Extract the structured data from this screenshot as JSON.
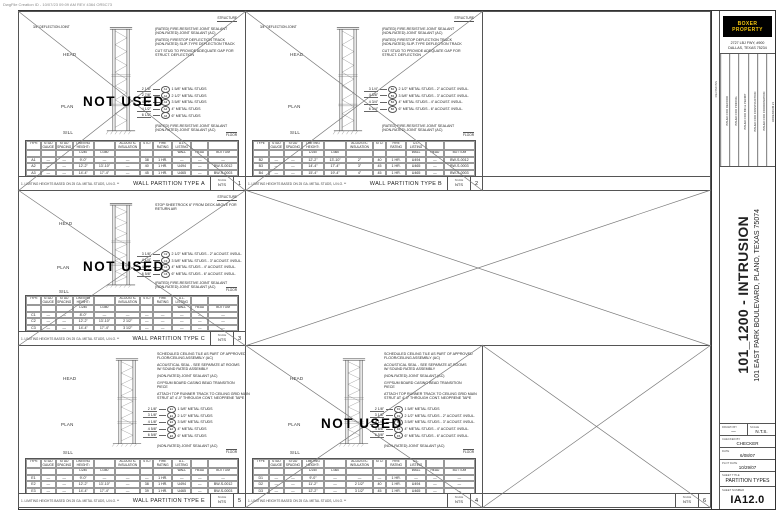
{
  "plot_stamp": "DwgFile Creation ID - 10/07/23 09:09 AM REV 4364 OR5C73",
  "table_note": "1. LIMITING HEIGHTS BASED ON 25 GA. METAL STUDS, U.N.O. **",
  "panels": {
    "a": {
      "title": "WALL PARTITION TYPE A",
      "number": "1",
      "scale_label": "SCALE",
      "scale": "NTS",
      "footnote": "1. LIMITING HEIGHTS BASED ON 25 GA. METAL STUDS, U.N.O. **",
      "not_used": "NOT USED",
      "structure_label": "STRUCTURE",
      "floor_label": "FLOOR",
      "deflection_label": "3/4\" DEFLECTION JOINT",
      "head_label": "HEAD",
      "plan_label": "PLAN",
      "sill_label": "SILL",
      "notes_top": [
        "(RATED) FIRE-RESISTIVE JOINT SEALANT\n(NON-RATED) JOINT SEALANT (AC)",
        "(RATED) FIRESTOP DEFLECTION TRACK\n(NON-RATED) SLIP-TYPE DEFLECTION TRACK",
        "CUT STUD TO PROVIDE ADEQUATE GAP FOR\nSTRUCT. DEFLECTION"
      ],
      "studs": [
        {
          "dim": "2 1/8\"",
          "tag": "A1",
          "text": "1 5/8\" METAL STUDS"
        },
        {
          "dim": "2 7/8\"",
          "tag": "A2",
          "text": "2 1/2\" METAL STUDS"
        },
        {
          "dim": "4 1/8\"",
          "tag": "A3",
          "text": "3 5/8\" METAL STUDS"
        },
        {
          "dim": "4 1/2\"",
          "tag": "A4",
          "text": "4\" METAL STUDS"
        },
        {
          "dim": "6 1/2\"",
          "tag": "A6",
          "text": "6\" METAL STUDS"
        }
      ],
      "note_bottom": "(RATED) FIRE-RESISTIVE JOINT SEALANT\n(NON-RATED) JOINT SEALANT (AC)",
      "table": {
        "rows": [
          [
            "TYPE",
            "STUD GAUGE",
            "STUD SPACING",
            "LIMITING HEIGHT¹",
            "",
            "ACOUSTIC INSULATION",
            "STC²",
            "FIRE RATING",
            "U.L. LISTING",
            "",
            ""
          ],
          [
            "",
            "",
            "",
            "L/240",
            "L/360",
            "",
            "",
            "",
            "WALL",
            "HEAD",
            "BOTTOM"
          ],
          [
            "A1",
            "—",
            "—",
            "9'-0\"",
            "—",
            "—",
            "38",
            "1 HR.",
            "—",
            "—",
            "—"
          ],
          [
            "A2",
            "—",
            "—",
            "12'-2\"",
            "13'-10\"",
            "—",
            "40",
            "1 HR.",
            "U494",
            "—",
            "BW-S-0012"
          ],
          [
            "A3",
            "—",
            "—",
            "14'-4\"",
            "17'-4\"",
            "—",
            "45",
            "1 HR.",
            "U465",
            "—",
            "BW-S-0003"
          ],
          [
            "A4",
            "—",
            "—",
            "15'-4\"",
            "19'-4\"",
            "—",
            "45",
            "1 HR.",
            "U465",
            "—",
            "BW-S-0003"
          ],
          [
            "A6",
            "—",
            "—",
            "19'-8\"",
            "21'-11\"",
            "—",
            "45",
            "1 HR.",
            "U465",
            "—",
            "BW-S-0003"
          ]
        ]
      }
    },
    "b": {
      "title": "WALL PARTITION TYPE B",
      "number": "2",
      "scale_label": "SCALE",
      "scale": "NTS",
      "footnote": "1. LIMITING HEIGHTS BASED ON 25 GA. METAL STUDS, U.N.O. **",
      "structure_label": "STRUCTURE",
      "floor_label": "FLOOR",
      "deflection_label": "3/4\" DEFLECTION JOINT",
      "head_label": "HEAD",
      "plan_label": "PLAN",
      "sill_label": "SILL",
      "notes_top": [
        "(RATED) FIRE-RESISTIVE JOINT SEALANT\n(NON-RATED) JOINT SEALANT (AC)",
        "(RATED) FIRESTOP DEFLECTION TRACK\n(NON-RATED) SLIP-TYPE DEFLECTION TRACK",
        "CUT STUD TO PROVIDE ADEQUATE GAP FOR\nSTRUCT. DEFLECTION"
      ],
      "studs": [
        {
          "dim": "3 1/4\"",
          "tag": "B2",
          "text": "2 1/2\" METAL STUDS - 2\" ACOUST. INSUL."
        },
        {
          "dim": "4 3/8\"",
          "tag": "B3",
          "text": "3 5/8\" METAL STUDS - 3\" ACOUST. INSUL."
        },
        {
          "dim": "4 3/4\"",
          "tag": "B4",
          "text": "4\" METAL STUDS - 4\" ACOUST. INSUL."
        },
        {
          "dim": "6 3/4\"",
          "tag": "B6",
          "text": "6\" METAL STUDS - 6\" ACOUST. INSUL."
        }
      ],
      "note_bottom": "(RATED) FIRE-RESISTIVE JOINT SEALANT\n(NON-RATED) JOINT SEALANT (AC)",
      "table": {
        "rows": [
          [
            "TYPE",
            "STUD GAUGE",
            "STUD SPACING",
            "LIMITING HEIGHT¹",
            "",
            "ACOUSTIC INSULATION",
            "STC²",
            "FIRE RATING",
            "U.L. LISTING",
            "",
            ""
          ],
          [
            "",
            "",
            "",
            "L/240",
            "L/360",
            "",
            "",
            "",
            "WALL",
            "HEAD",
            "BOTTOM"
          ],
          [
            "B2",
            "—",
            "—",
            "12'-2\"",
            "13'-10\"",
            "2\"",
            "40",
            "1 HR.",
            "U494",
            "—",
            "BW-S-0012"
          ],
          [
            "B3",
            "—",
            "—",
            "14'-4\"",
            "17'-4\"",
            "3\"",
            "45",
            "1 HR.",
            "U465",
            "—",
            "BW-S-0003"
          ],
          [
            "B4",
            "—",
            "—",
            "15'-4\"",
            "19'-4\"",
            "4\"",
            "45",
            "1 HR.",
            "U465",
            "—",
            "BW-S-0003"
          ],
          [
            "B6",
            "—",
            "—",
            "19'-8\"",
            "21'-11\"",
            "6\"",
            "45",
            "1 HR.",
            "U465",
            "—",
            "BW-S-0003"
          ]
        ]
      }
    },
    "c": {
      "title": "WALL PARTITION TYPE C",
      "number": "3",
      "scale_label": "SCALE",
      "scale": "NTS",
      "footnote": "1. LIMITING HEIGHTS BASED ON 25 GA. METAL STUDS, U.N.O. **",
      "not_used": "NOT USED",
      "structure_label": "STRUCTURE",
      "floor_label": "FLOOR",
      "head_label": "HEAD",
      "plan_label": "PLAN",
      "sill_label": "SILL",
      "notes_top": [
        "STOP SHEETROCK 6\" FROM DECK ABOVE FOR\nRETURN AIR"
      ],
      "studs": [
        {
          "dim": "3 1/8\"",
          "tag": "C2",
          "text": "2 1/2\" METAL STUDS - 2\" ACOUST. INSUL."
        },
        {
          "dim": "4 1/4\"",
          "tag": "C3",
          "text": "3 5/8\" METAL STUDS - 3\" ACOUST. INSUL."
        },
        {
          "dim": "4 5/8\"",
          "tag": "C4",
          "text": "4\" METAL STUDS - 4\" ACOUST. INSUL."
        },
        {
          "dim": "6 5/8\"",
          "tag": "C6",
          "text": "6\" METAL STUDS - 6\" ACOUST. INSUL."
        }
      ],
      "note_bottom": "(RATED) FIRE-RESISTIVE JOINT SEALANT\n(NON-RATED) JOINT SEALANT (AC)",
      "table": {
        "rows": [
          [
            "TYPE",
            "STUD GAUGE",
            "STUD SPACING",
            "LIMITING HEIGHT¹",
            "",
            "ACOUSTIC INSULATION",
            "STC²",
            "FIRE RATING",
            "U.L. LISTING",
            "",
            ""
          ],
          [
            "",
            "",
            "",
            "L/240",
            "L/360",
            "",
            "",
            "",
            "WALL",
            "HEAD",
            "BOTTOM"
          ],
          [
            "C1",
            "—",
            "—",
            "8'-0\"",
            "—",
            "—",
            "—",
            "—",
            "—",
            "—",
            "—"
          ],
          [
            "C2",
            "—",
            "—",
            "12'-2\"",
            "13'-10\"",
            "2 1/2\"",
            "—",
            "—",
            "—",
            "—",
            "—"
          ],
          [
            "C3",
            "—",
            "—",
            "14'-4\"",
            "17'-4\"",
            "3 1/2\"",
            "—",
            "—",
            "—",
            "—",
            "—"
          ],
          [
            "C4",
            "—",
            "—",
            "15'-4\"",
            "19'-4\"",
            "4\"",
            "—",
            "—",
            "—",
            "—",
            "—"
          ],
          [
            "C6",
            "—",
            "—",
            "19'-8\"",
            "21'-11\"",
            "6\"",
            "—",
            "—",
            "—",
            "—",
            "—"
          ]
        ]
      }
    },
    "d": {
      "title": "",
      "number": "4",
      "scale_label": "SCALE",
      "scale": "NTS",
      "footnote": "1. LIMITING HEIGHTS BASED ON 25 GA. METAL STUDS, U.N.O. **",
      "not_used": "NOT USED",
      "floor_label": "FLOOR",
      "head_label": "HEAD",
      "plan_label": "PLAN",
      "sill_label": "SILL",
      "notes_top": [
        "SCHEDULED CEILING TILE AS PART OF APPROVED\nFLOOR/CEILING ASSEMBLY (AC)",
        "ACOUSTICAL SEAL - SEE SEPARATE AT ROOMS\nW/ SOUND RATED ASSEMBLY",
        "(NON-RATED) JOINT SEALANT (AC)",
        "GYPSUM BOARD CASING BEAD TRANSITION\nPIECE",
        "ATTACH TOP RUNNER TRACK TO CEILING GRID MAIN\nSTRUT AT 4'-0\" THROUGH CONT. NEOPRENE TAPE"
      ],
      "studs": [
        {
          "dim": "2 1/8\"",
          "tag": "D1",
          "text": "1 5/8\" METAL STUDS"
        },
        {
          "dim": "3 1/8\"",
          "tag": "D2",
          "text": "2 1/2\" METAL STUDS - 2\" ACOUST. INSUL."
        },
        {
          "dim": "4 1/4\"",
          "tag": "D3",
          "text": "3 5/8\" METAL STUDS - 3\" ACOUST. INSUL."
        },
        {
          "dim": "4 5/8\"",
          "tag": "D4",
          "text": "4\" METAL STUDS - 4\" ACOUST. INSUL."
        },
        {
          "dim": "6 5/8\"",
          "tag": "D6",
          "text": "6\" METAL STUDS - 6\" ACOUST. INSUL."
        }
      ],
      "note_bottom": "(NON-RATED) JOINT SEALANT (AC)",
      "table": {
        "rows": [
          [
            "TYPE",
            "STUD GAUGE",
            "STUD SPACING",
            "LIMITING HEIGHT¹",
            "",
            "ACOUSTIC INSULATION",
            "STC²",
            "FIRE RATING",
            "U.L. LISTING",
            "",
            ""
          ],
          [
            "",
            "",
            "",
            "L/240",
            "L/360",
            "",
            "",
            "",
            "WALL",
            "HEAD",
            "BOTTOM"
          ],
          [
            "D1",
            "—",
            "—",
            "9'-0\"",
            "—",
            "—",
            "—",
            "1 HR.",
            "—",
            "—",
            "—"
          ],
          [
            "D2",
            "—",
            "—",
            "11'-2\"",
            "—",
            "2 1/2\"",
            "40",
            "1 HR.",
            "U494",
            "—",
            "—"
          ],
          [
            "D3",
            "—",
            "—",
            "12'-2\"",
            "—",
            "3 1/2\"",
            "45",
            "1 HR.",
            "U465",
            "—",
            "—"
          ],
          [
            "D4",
            "—",
            "—",
            "12'-4\"",
            "—",
            "4\"",
            "44",
            "1 HR.",
            "U465",
            "—",
            "—"
          ],
          [
            "D6",
            "—",
            "—",
            "13'-4\"",
            "—",
            "6\"",
            "45",
            "1 HR.",
            "U465",
            "—",
            "—"
          ]
        ]
      }
    },
    "e": {
      "title": "WALL PARTITION TYPE E",
      "number": "5",
      "scale_label": "SCALE",
      "scale": "NTS",
      "footnote": "1. LIMITING HEIGHTS BASED ON 25 GA. METAL STUDS, U.N.O. **",
      "floor_label": "FLOOR",
      "head_label": "HEAD",
      "plan_label": "PLAN",
      "sill_label": "SILL",
      "notes_top": [
        "SCHEDULED CEILING TILE AS PART OF APPROVED\nFLOOR/CEILING ASSEMBLY (AC)",
        "ACOUSTICAL SEAL - SEE SEPARATE AT ROOMS\nW/ SOUND RATED ASSEMBLY",
        "(NON-RATED) JOINT SEALANT (AC)",
        "GYPSUM BOARD CASING BEAD TRANSITION\nPIECE",
        "ATTACH TOP RUNNER TRACK TO CEILING GRID MAIN\nSTRUT AT 4'-0\" THROUGH CONT. NEOPRENE TAPE"
      ],
      "studs": [
        {
          "dim": "2 1/8\"",
          "tag": "E1",
          "text": "1 5/8\" METAL STUDS"
        },
        {
          "dim": "3 1/8\"",
          "tag": "E2",
          "text": "2 1/2\" METAL STUDS"
        },
        {
          "dim": "4 1/8\"",
          "tag": "E3",
          "text": "3 5/8\" METAL STUDS"
        },
        {
          "dim": "4 5/8\"",
          "tag": "E4",
          "text": "4\" METAL STUDS"
        },
        {
          "dim": "6 5/8\"",
          "tag": "E6",
          "text": "6\" METAL STUDS"
        }
      ],
      "note_bottom": "(NON-RATED) JOINT SEALANT (AC)",
      "table": {
        "rows": [
          [
            "TYPE",
            "STUD GAUGE",
            "STUD SPACING",
            "LIMITING HEIGHT¹",
            "",
            "ACOUSTIC INSULATION",
            "STC²",
            "FIRE RATING",
            "U.L. LISTING",
            "",
            ""
          ],
          [
            "",
            "",
            "",
            "L/240",
            "L/360",
            "",
            "",
            "",
            "WALL",
            "HEAD",
            "BOTTOM"
          ],
          [
            "E1",
            "—",
            "—",
            "9'-0\"",
            "—",
            "—",
            "—",
            "1 HR.",
            "—",
            "—",
            "—"
          ],
          [
            "E2",
            "—",
            "—",
            "12'-2\"",
            "13'-10\"",
            "—",
            "38",
            "1 HR.",
            "U494",
            "—",
            "BW-S-0012"
          ],
          [
            "E3",
            "—",
            "—",
            "14'-4\"",
            "17'-4\"",
            "—",
            "39",
            "1 HR.",
            "U465",
            "—",
            "BW-S-0003"
          ],
          [
            "E4",
            "—",
            "—",
            "15'-4\"",
            "19'-4\"",
            "—",
            "39",
            "1 HR.",
            "U465",
            "—",
            "BW-S-0003"
          ],
          [
            "E6",
            "—",
            "—",
            "19'-8\"",
            "21'-11\"",
            "—",
            "39",
            "1 HR.",
            "U465",
            "—",
            "BW-S-0003"
          ]
        ]
      }
    },
    "f": {
      "title": "",
      "number": "6",
      "scale_label": "SCALE",
      "scale": "NTS"
    }
  },
  "titleblock": {
    "logo_text": "BOXER PROPERTY",
    "address1": "2727 LBJ FWY, #900",
    "address2": "DALLAS, TEXAS 75234",
    "revisions_label": "REVISIONS",
    "revisions": [
      "ISSUED FOR RECORD",
      "ISSUED FOR PRICING",
      "ISSUED FOR BID & PERMIT",
      "ISSUED FOR CONSTRUCTION",
      "ISSUED FOR COORDINATION",
      "ADDENDUM #1"
    ],
    "project_title": "101_1200 - INTRUSION",
    "project_address": "101 EAST PARK BOULEVARD, PLANO, TEXAS 75074",
    "drawn_by_label": "DRAWN BY",
    "drawn_by": "—",
    "scale_label": "SCALE",
    "scale_value": "N.T.S.",
    "checked_by_label": "CHECKED BY",
    "checked_by": "CHECKER",
    "date_label": "DATE",
    "date_value": "6/08/07",
    "plot_date_label": "PLOT DATE",
    "plot_date_value": "10/29/07",
    "sheet_title_label": "SHEET TITLE",
    "sheet_title": "PARTITION TYPES",
    "sheet_number_label": "SHEET NUMBER",
    "sheet_number": "IA12.0"
  }
}
